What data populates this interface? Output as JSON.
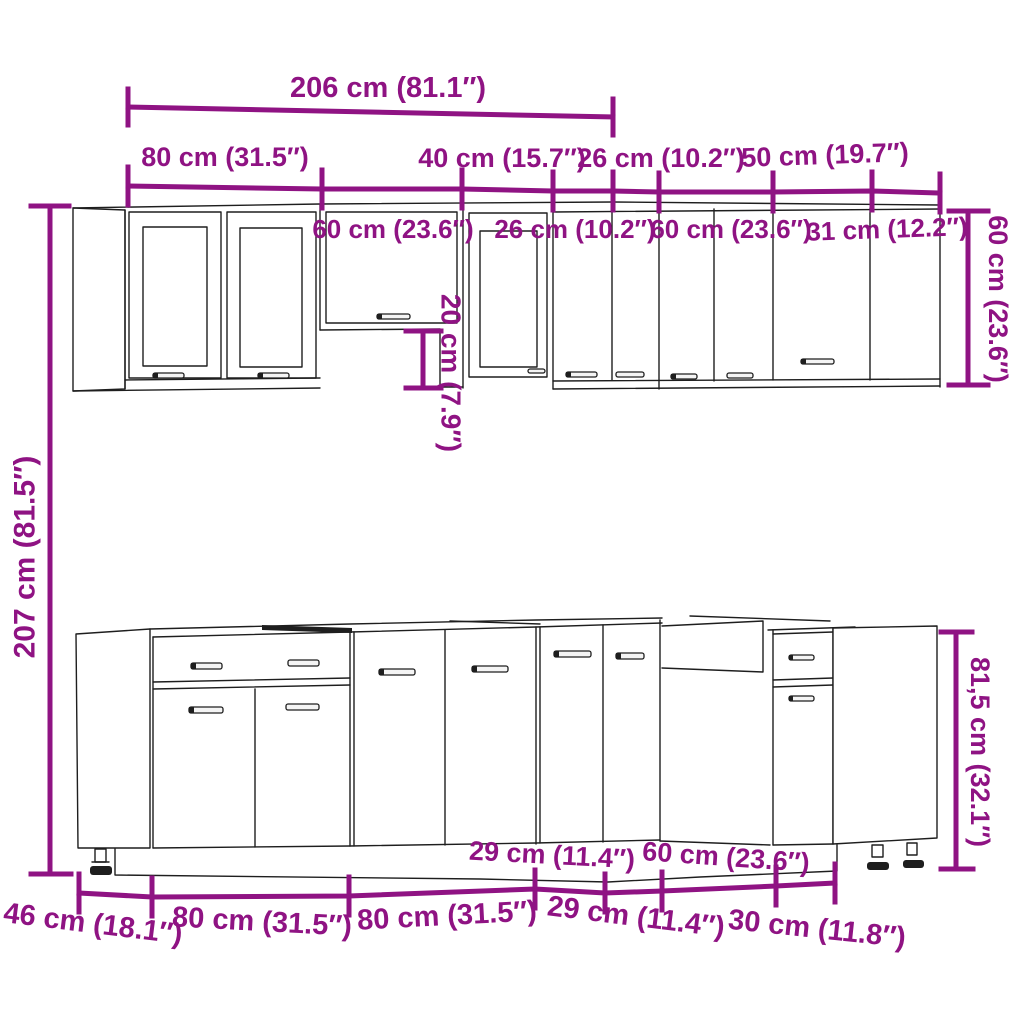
{
  "colors": {
    "dimension": "#8F1383",
    "outline": "#1e1e1e",
    "background": "#ffffff"
  },
  "diagram": {
    "description": "Kitchen cabinet set dimension drawing, L-shaped unit with wall and base cabinets",
    "dimensions": {
      "top_total": "206 cm (81.1″)",
      "wall_upper": [
        "80 cm (31.5″)",
        "40 cm (15.7″)",
        "26 cm (10.2″)",
        "50 cm (19.7″)"
      ],
      "wall_lower": [
        "60 cm (23.6″)",
        "26 cm (10.2″)",
        "60 cm (23.6″)",
        "31 cm (12.2″)"
      ],
      "height_total": "207 cm (81.5″)",
      "hood_gap_height": "20 cm (7.9″)",
      "wall_cabinet_height": "60 cm (23.6″)",
      "base_cabinet_height": "81,5 cm (32.1″)",
      "base_upper": [
        "29 cm (11.4″)",
        "60 cm (23.6″)"
      ],
      "base_lower": [
        "46 cm (18.1″)",
        "80 cm (31.5″)",
        "80 cm (31.5″)",
        "29 cm (11.4″)",
        "30 cm (11.8″)"
      ]
    }
  }
}
